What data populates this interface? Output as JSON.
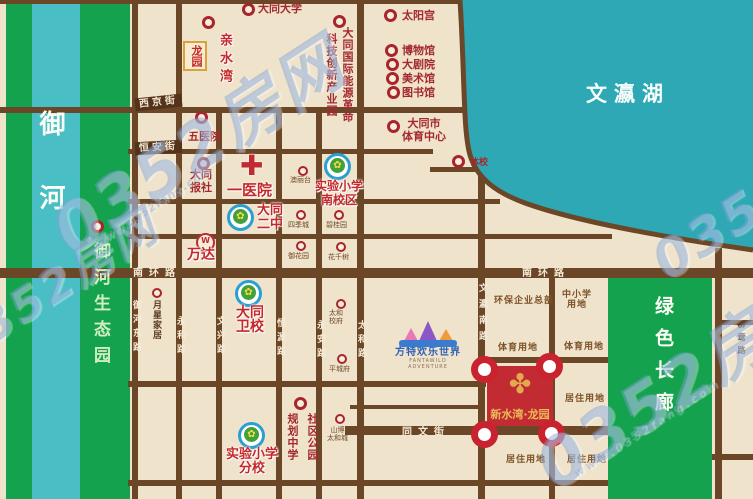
{
  "colors": {
    "background": "#EFE3CC",
    "road": "#6B4627",
    "river_green": "#15A24F",
    "river_teal": "#49BFC5",
    "lake": "#2EA8B4",
    "accent_red": "#C4282A",
    "marker_red": "#A8242E",
    "gold": "#E2A94F",
    "project_red": "#C32B32"
  },
  "icons": {
    "school_badge": "✿",
    "hospital_cross": "✚",
    "ornament": "✤",
    "wanda_logo": "W"
  },
  "water": {
    "river": "御河",
    "river_park": "御河生态园",
    "lake": "文瀛湖",
    "corridor": "绿色长廊"
  },
  "streets": {
    "xijing": "西京街",
    "hengan": "恒安街",
    "nanhuan": "南环路",
    "tongwen": "同文街",
    "yuhedong": "御河东路",
    "yonghe": "永和路",
    "wenxing": "文兴路",
    "hengyuan": "恒源路",
    "yongan": "永安路",
    "taihe": "太和路",
    "wenyingnan": "文瀛南路",
    "liuying": "柳莺路"
  },
  "pois": {
    "qinshuiwan": "亲水湾",
    "longyuan": "龙园",
    "datong_univ": "大同大学",
    "energy_line1": "大同国际能源革命",
    "energy_line2": "科技创新产业园",
    "taiyanggong": "太阳宫",
    "bowuguan": "博物馆",
    "dajuyuan": "大剧院",
    "meishuguan": "美术馆",
    "tushuguan": "图书馆",
    "sports_center_l1": "大同市",
    "sports_center_l2": "体育中心",
    "tixiao": "体校",
    "wuyiyuan": "五医院",
    "baoshe_l1": "大同",
    "baoshe_l2": "报社",
    "yiyiyuan": "一医院",
    "exp_south_l1": "实验小学",
    "exp_south_l2": "南校区",
    "aolitai": "澳丽台",
    "erzhong_l1": "大同",
    "erzhong_l2": "二中",
    "sijicheng": "四季城",
    "biguiyuan": "碧桂园",
    "yuhuayuan": "御花园",
    "huaqianshu": "花千树",
    "wanda": "万达",
    "yuexing": "月星家居",
    "weixiao_l1": "大同",
    "weixiao_l2": "卫校",
    "taihe_xiaofu_l1": "太和",
    "taihe_xiaofu_l2": "校府",
    "pingchengfu": "平城府",
    "exp_branch_l1": "实验小学",
    "exp_branch_l2": "分校",
    "shequ_gongyuan": "社区公园",
    "guihua_zhongxue": "规划中学",
    "shanbo_l1": "山博",
    "shanbo_l2": "太和城",
    "fangte": "方特欢乐世界",
    "fangte_en": "FANTAWILD ADVENTURE",
    "xinshuiwan": "新水湾·龙园"
  },
  "landuse": {
    "env_hq": "环保企业总部",
    "zxx_l1": "中小学",
    "zxx_l2": "用地",
    "sports": "体育用地",
    "residential": "居住用地"
  },
  "watermark": {
    "text": "0352房网",
    "url": "www.0352fang.com"
  }
}
